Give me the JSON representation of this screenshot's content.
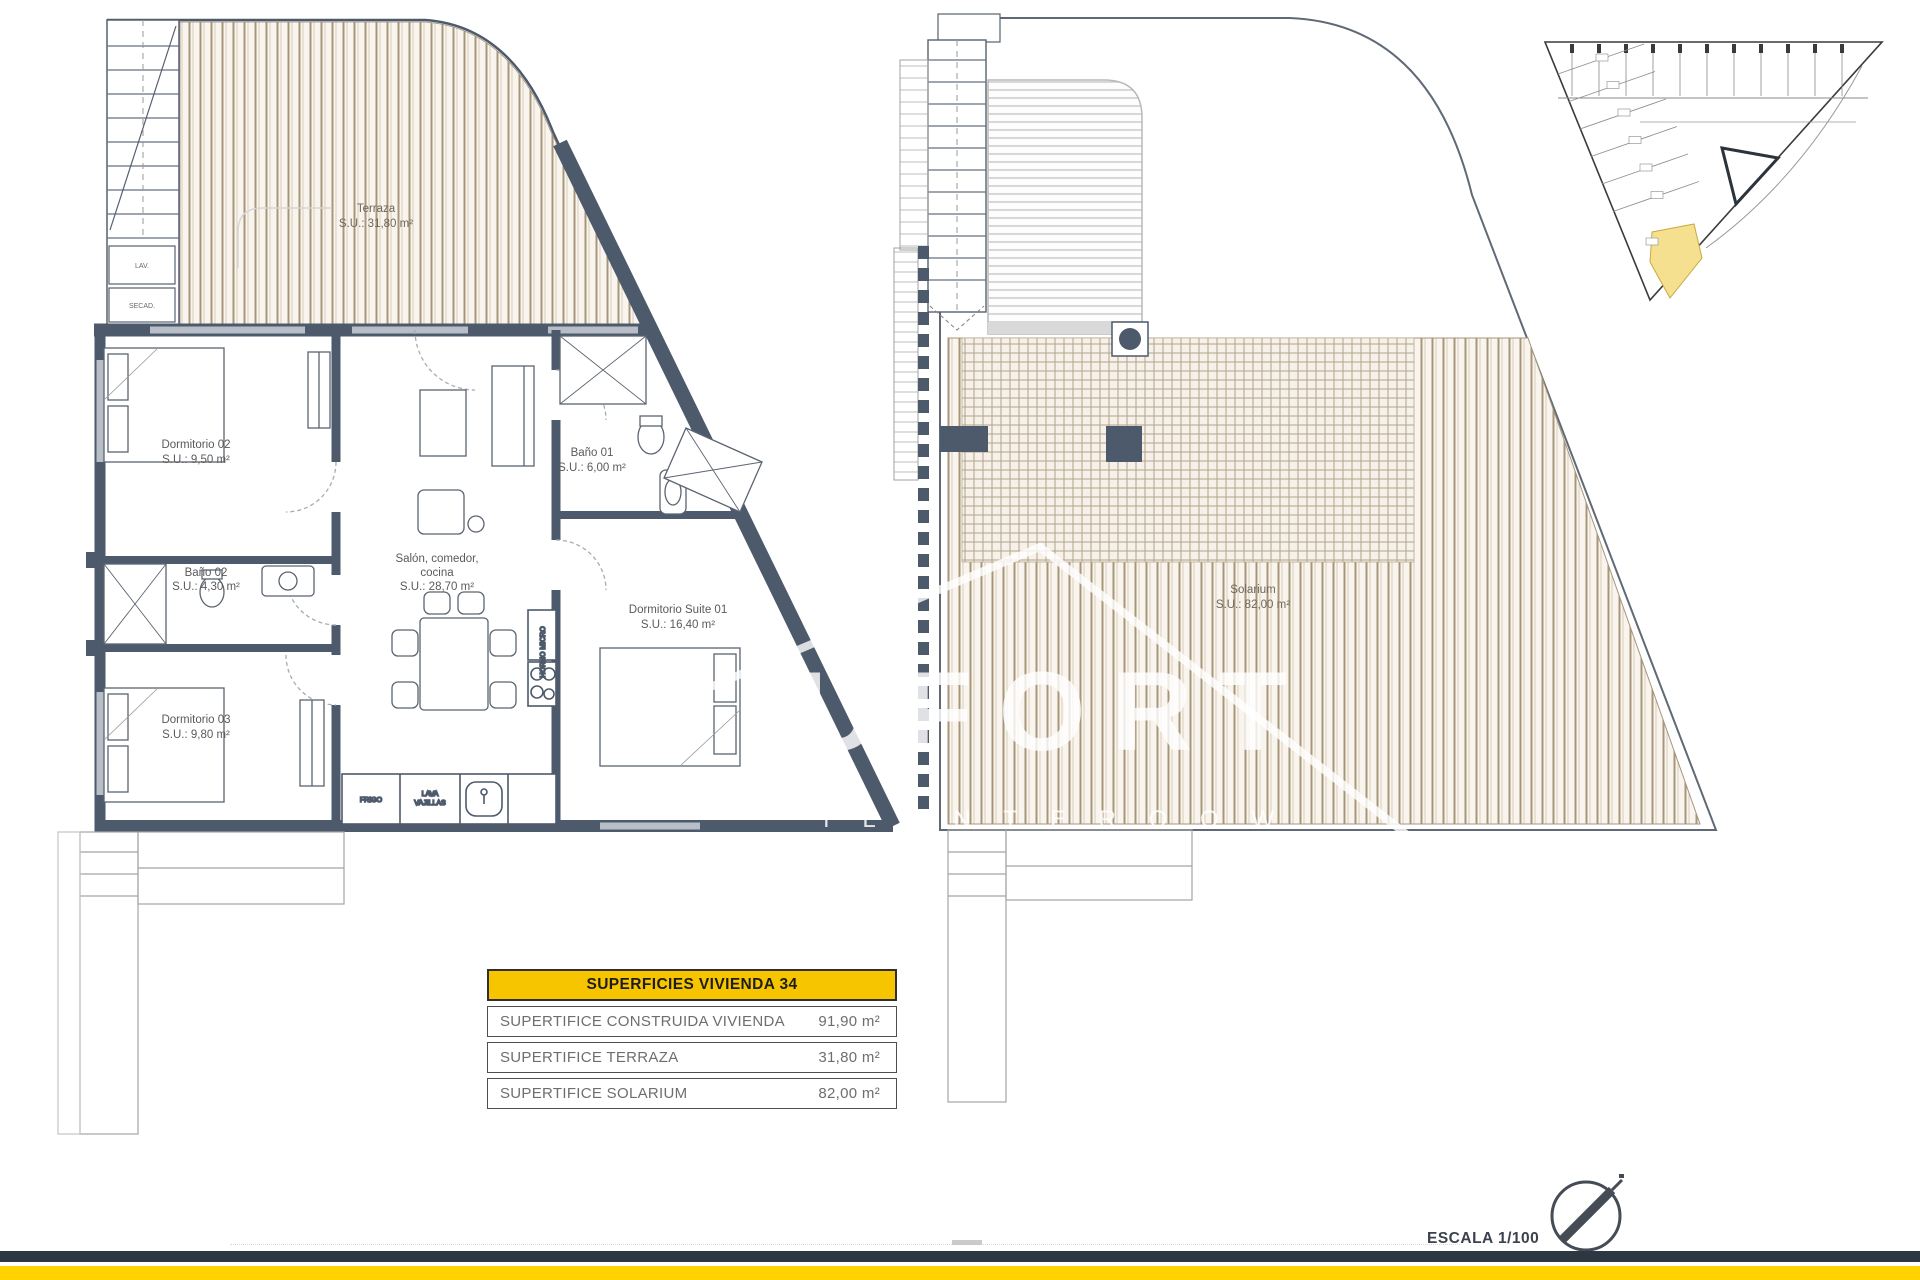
{
  "document": {
    "scale_label": "ESCALA 1/100",
    "watermark": {
      "line1": "UFORT",
      "line2": "I L A   N T E R   O O W"
    }
  },
  "floor_plan": {
    "rooms": {
      "terraza": {
        "label": "Terraza",
        "area": "S.U.: 31,80 m²"
      },
      "dorm02": {
        "label": "Dormitorio 02",
        "area": "S.U.: 9,50 m²"
      },
      "bano01": {
        "label": "Baño 01",
        "area": "S.U.: 6,00 m²"
      },
      "salon": {
        "line1": "Salón, comedor,",
        "line2": "cocina",
        "area": "S.U.: 28,70 m²"
      },
      "bano02": {
        "label": "Baño 02",
        "area": "S.U.: 4,30 m²"
      },
      "suite": {
        "label": "Dormitorio Suite 01",
        "area": "S.U.: 16,40 m²"
      },
      "dorm03": {
        "label": "Dormitorio 03",
        "area": "S.U.: 9,80 m²"
      }
    },
    "kitchen": {
      "fridge": "FRIGO",
      "dishwasher_line1": "LAVA",
      "dishwasher_line2": "VAJILLAS",
      "oven_label": "HORNO MICRO"
    },
    "laundry": {
      "washer": "LAV.",
      "dryer": "SECAD."
    }
  },
  "roof_plan": {
    "rooms": {
      "solarium": {
        "label": "Solarium",
        "area": "S.U.: 82,00 m²"
      }
    }
  },
  "areas_table": {
    "header": "SUPERFICIES VIVIENDA 34",
    "rows": [
      {
        "label": "SUPERTIFICE CONSTRUIDA VIVIENDA",
        "value": "91,90 m²"
      },
      {
        "label": "SUPERTIFICE TERRAZA",
        "value": "31,80 m²"
      },
      {
        "label": "SUPERTIFICE SOLARIUM",
        "value": "82,00 m²"
      }
    ]
  },
  "colors": {
    "wall": "#4d5a6b",
    "window": "#b7bec7",
    "deck_line": "#a8967a",
    "table_header_yellow": "#F6C500",
    "footer_yellow": "#FFD200",
    "footer_dark": "#2D3741",
    "site_highlight": "#F5E08F"
  }
}
